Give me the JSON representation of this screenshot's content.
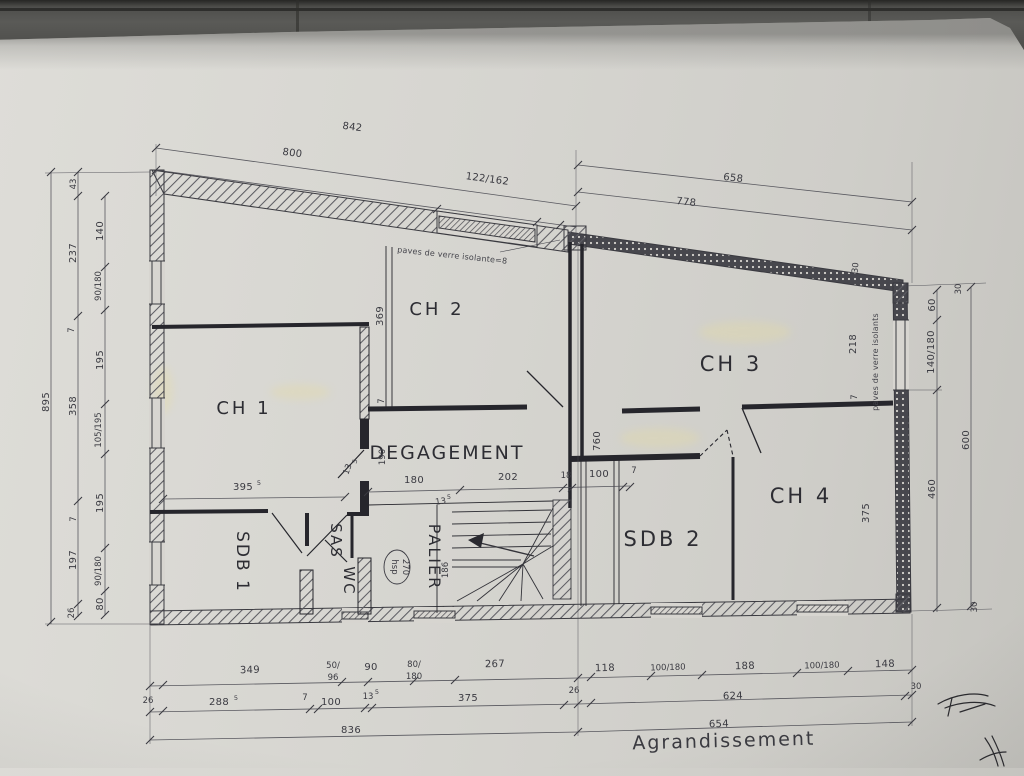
{
  "colors": {
    "paper": "#d7d5d0",
    "floor": "#4c4c49",
    "ink": "#3a3a41",
    "wall": "#27272d",
    "highlight": "#e6dca0"
  },
  "plan": {
    "rooms": {
      "ch1": "CH 1",
      "ch2": "CH 2",
      "ch3": "CH 3",
      "ch4": "CH 4",
      "sdb1": "SDB 1",
      "sdb2": "SDB 2",
      "sas": "SAS",
      "wc": "WC",
      "palier": "PALIER",
      "degagement": "DEGAGEMENT"
    },
    "annotations": {
      "glass_top": "paves de verre isolante=8",
      "glass_right": "paves de verre isolants",
      "hsp_line1": "hsp",
      "hsp_line2": "270",
      "title": "Agrandissement"
    },
    "dims": {
      "t842": "842",
      "t800": "800",
      "t122": "122/162",
      "t658": "658",
      "t778": "778",
      "r30a": "30",
      "r30b": "30",
      "r60": "60",
      "r140": "140/180",
      "r460": "460",
      "r600": "600",
      "r30c": "30",
      "r218": "218",
      "r7": "7",
      "v375": "375",
      "l895": "895",
      "l43": "43",
      "l237": "237",
      "l7a": "7",
      "l358": "358",
      "l7b": "7",
      "l197": "197",
      "l26": "26",
      "li140": "140",
      "li90a": "90/180",
      "li195a": "195",
      "li105": "105/195",
      "li195b": "195",
      "li90b": "90/180",
      "li80": "80",
      "v369": "369",
      "v7c": "7",
      "v190": "190",
      "v760": "760",
      "c395": "395",
      "c395s": "5",
      "c13": "13",
      "c13s": "5",
      "d180": "180",
      "d202": "202",
      "d18": "18",
      "d100": "100",
      "d7": "7",
      "s13": "13",
      "s13s": "5",
      "s186": "186",
      "b349": "349",
      "b50": "50/",
      "b96": "96",
      "b90": "90",
      "b80": "80/",
      "b180": "180",
      "b267": "267",
      "b26l": "26",
      "b288": "288",
      "b288s": "5",
      "b7": "7",
      "b100": "100",
      "b13": "13",
      "b13s": "5",
      "b375": "375",
      "b26r": "26",
      "b836": "836",
      "e118": "118",
      "e100a": "100/180",
      "e188": "188",
      "e100b": "100/180",
      "e148": "148",
      "e30": "30",
      "e624": "624",
      "e654": "654"
    }
  }
}
